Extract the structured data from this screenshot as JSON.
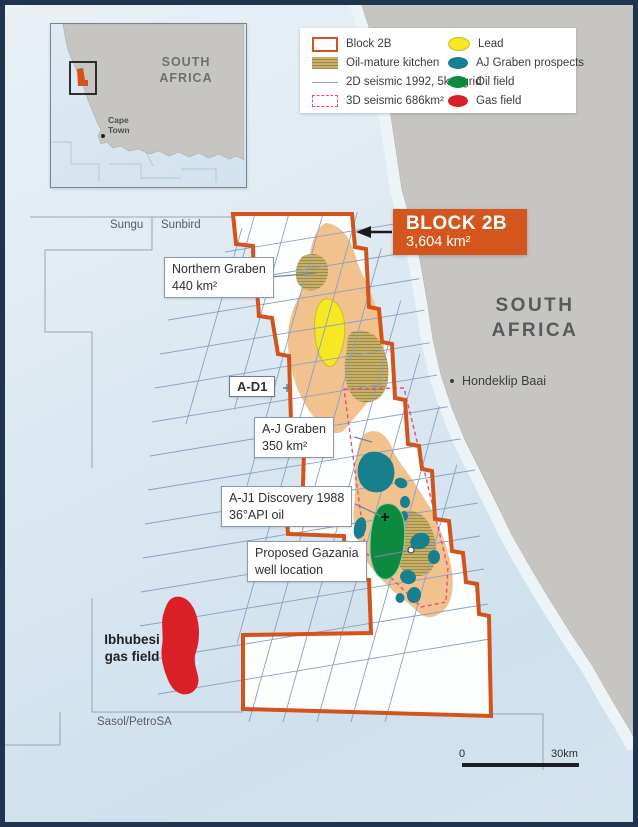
{
  "legend": {
    "left": [
      {
        "label": "Block 2B"
      },
      {
        "label": "Oil-mature kitchen"
      },
      {
        "label": "2D seismic 1992, 5km grid"
      },
      {
        "label": "3D seismic 686km²"
      }
    ],
    "right": [
      {
        "label": "Lead"
      },
      {
        "label": "AJ Graben prospects"
      },
      {
        "label": "Oil field"
      },
      {
        "label": "Gas field"
      }
    ]
  },
  "block_label": {
    "title": "BLOCK 2B",
    "area": "3,604 km²"
  },
  "callouts": {
    "northern_graben": {
      "line1": "Northern Graben",
      "line2": "440 km²"
    },
    "aj_graben": {
      "line1": "A-J Graben",
      "line2": "350 km²"
    },
    "aj1": {
      "line1": "A-J1 Discovery 1988",
      "line2": "36°API oil"
    },
    "gazania": {
      "line1": "Proposed Gazania",
      "line2": "well location"
    },
    "ad1": "A-D1"
  },
  "place_labels": {
    "sungu": "Sungu",
    "sunbird": "Sunbird",
    "sasol": "Sasol/PetroSA",
    "south_africa": {
      "line1": "SOUTH",
      "line2": "AFRICA"
    },
    "hondeklip": "Hondeklip Baai",
    "ibhubesi": {
      "line1": "Ibhubesi",
      "line2": "gas field"
    }
  },
  "inset": {
    "south_africa": {
      "line1": "SOUTH",
      "line2": "AFRICA"
    },
    "cape_town": {
      "line1": "Cape",
      "line2": "Town"
    }
  },
  "scale": {
    "zero": "0",
    "max": "30km"
  },
  "colors": {
    "block_orange": "#d4531c",
    "kitchen_light": "#f2c28e",
    "kitchen_dark_hatch": "#c9b069",
    "lead_yellow": "#f6e823",
    "prospect_teal": "#177f8e",
    "oil_green": "#0d8a3f",
    "gas_red": "#d92026",
    "seismic_3d_pink": "#e84b86",
    "seismic_2d_line": "#8ba0c4",
    "land_gray": "#c7c5c2",
    "frame_navy": "#20344f"
  }
}
